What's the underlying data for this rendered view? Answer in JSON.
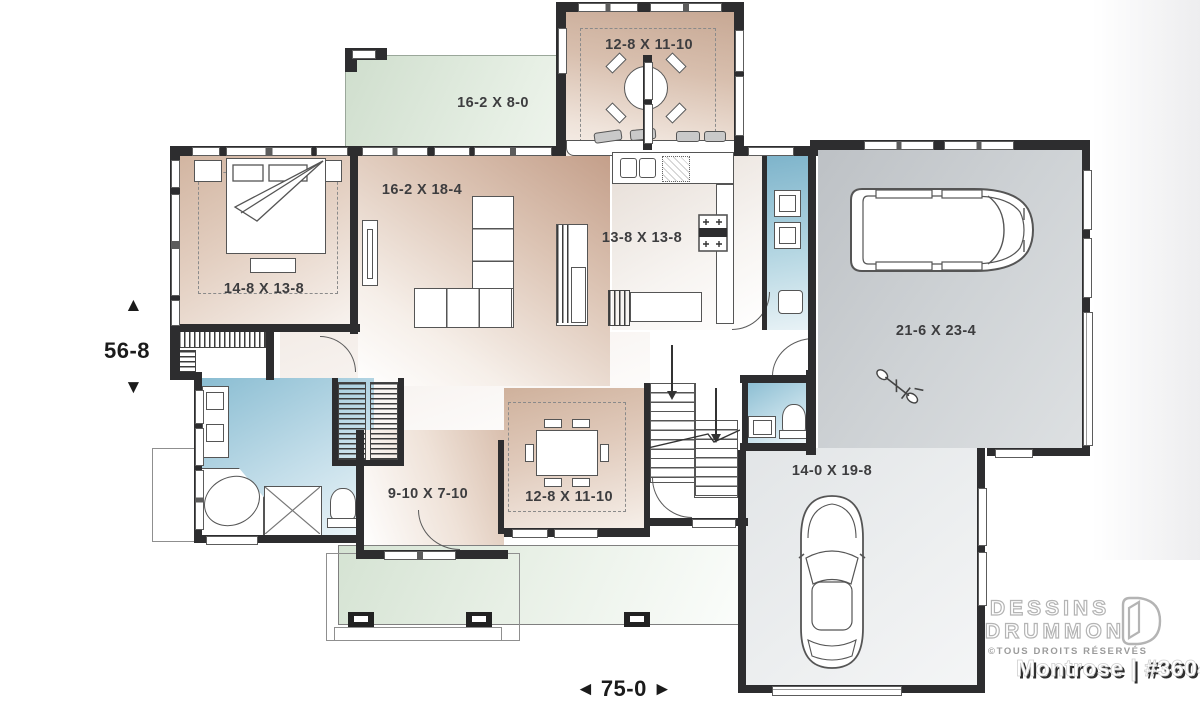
{
  "labels": {
    "deck": "16-2 X 8-0",
    "breakfast": "12-8 X 11-10",
    "living": "16-2 X 18-4",
    "kitchen": "13-8 X 13-8",
    "bedroom": "14-8 X 13-8",
    "garage": "21-6 X 23-4",
    "garage_bay": "14-0 X 19-8",
    "den": "9-10 X 7-10",
    "dining": "12-8 X 11-10"
  },
  "dimensions": {
    "depth": "56-8",
    "width": "75-0"
  },
  "arrows": {
    "up": "▲",
    "down": "▼",
    "left": "◄",
    "right": "►"
  },
  "branding": {
    "line1": "DESSINS",
    "line2": "DRUMMOND",
    "rights": "©TOUS DROITS RÉSERVÉS",
    "plan_name": "Montrose | #3604"
  },
  "colors": {
    "wall": "#2d2d2f",
    "tan": "#cdaf9b",
    "green": "#d6e4d4",
    "blue": "#8abdd2",
    "garage_gray": "#c6c9cc",
    "label_text": "#3d3d3f"
  }
}
